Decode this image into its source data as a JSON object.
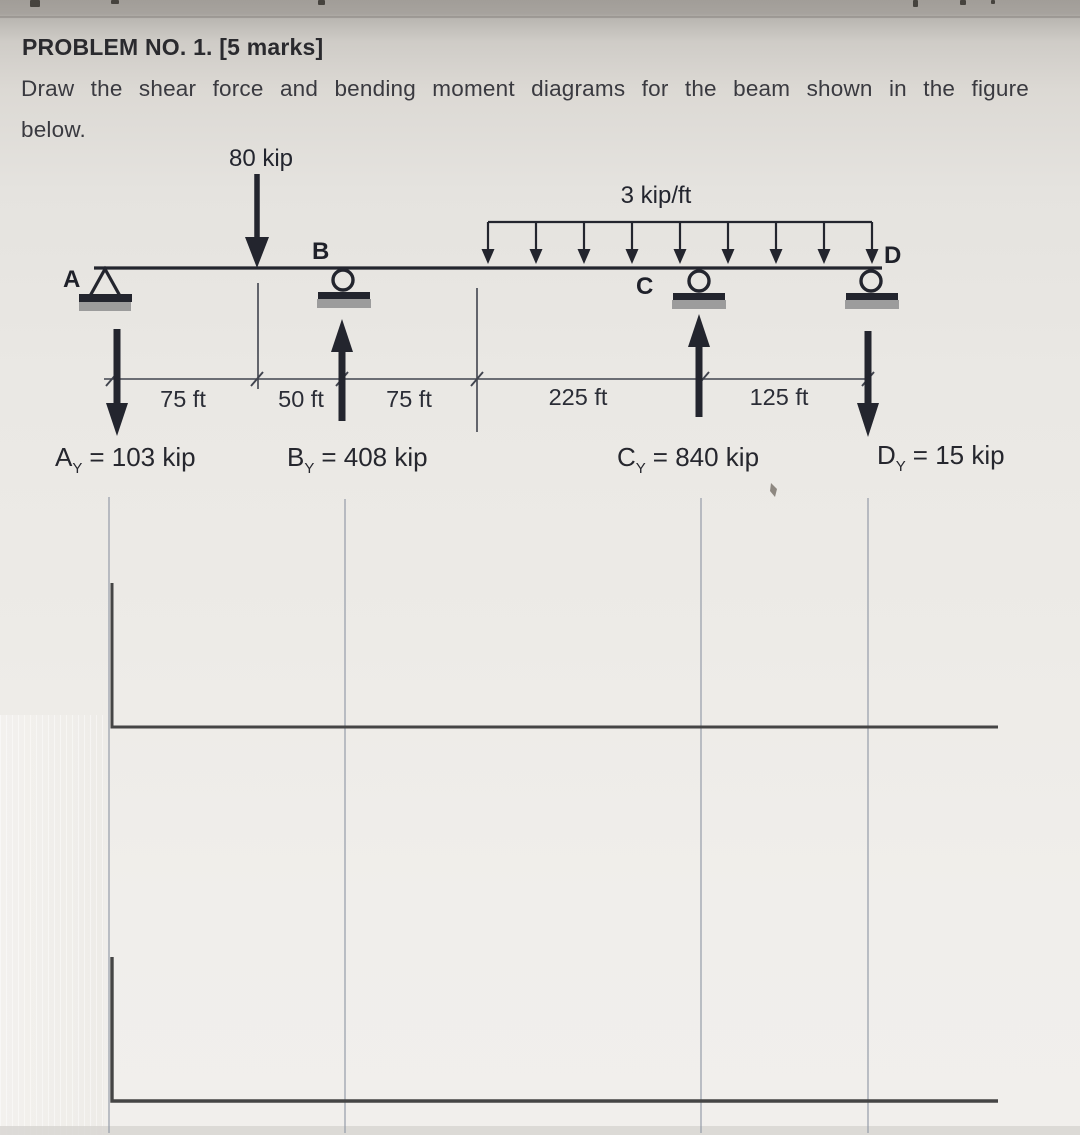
{
  "page": {
    "title": "PROBLEM NO. 1.",
    "title_marks": "[5 marks]",
    "description_line1": "Draw the shear force and bending moment diagrams for the beam shown in the figure",
    "description_line2": "below."
  },
  "figure": {
    "loads": {
      "point": "80 kip",
      "distributed": "3 kip/ft"
    },
    "nodes": {
      "a": "A",
      "b": "B",
      "c": "C",
      "d": "D"
    },
    "supports": {
      "a": "pin",
      "b": "roller",
      "c": "roller",
      "d": "roller"
    },
    "dimensions": [
      "75 ft",
      "50 ft",
      "75 ft",
      "225 ft",
      "125 ft"
    ],
    "reactions": {
      "a": {
        "letter": "A",
        "sub": "Y",
        "value": "= 103 kip",
        "direction": "down"
      },
      "b": {
        "letter": "B",
        "sub": "Y",
        "value": "= 408 kip",
        "direction": "up"
      },
      "c": {
        "letter": "C",
        "sub": "Y",
        "value": "= 840 kip",
        "direction": "up"
      },
      "d": {
        "letter": "D",
        "sub": "Y",
        "value": "= 15 kip",
        "direction": "down"
      }
    }
  },
  "colors": {
    "ink": "#23252e",
    "support_base_gray": "#9c9c9c",
    "grid_line": "#8d95a3",
    "axis": "#454545",
    "paper": "#ebe9e5"
  }
}
